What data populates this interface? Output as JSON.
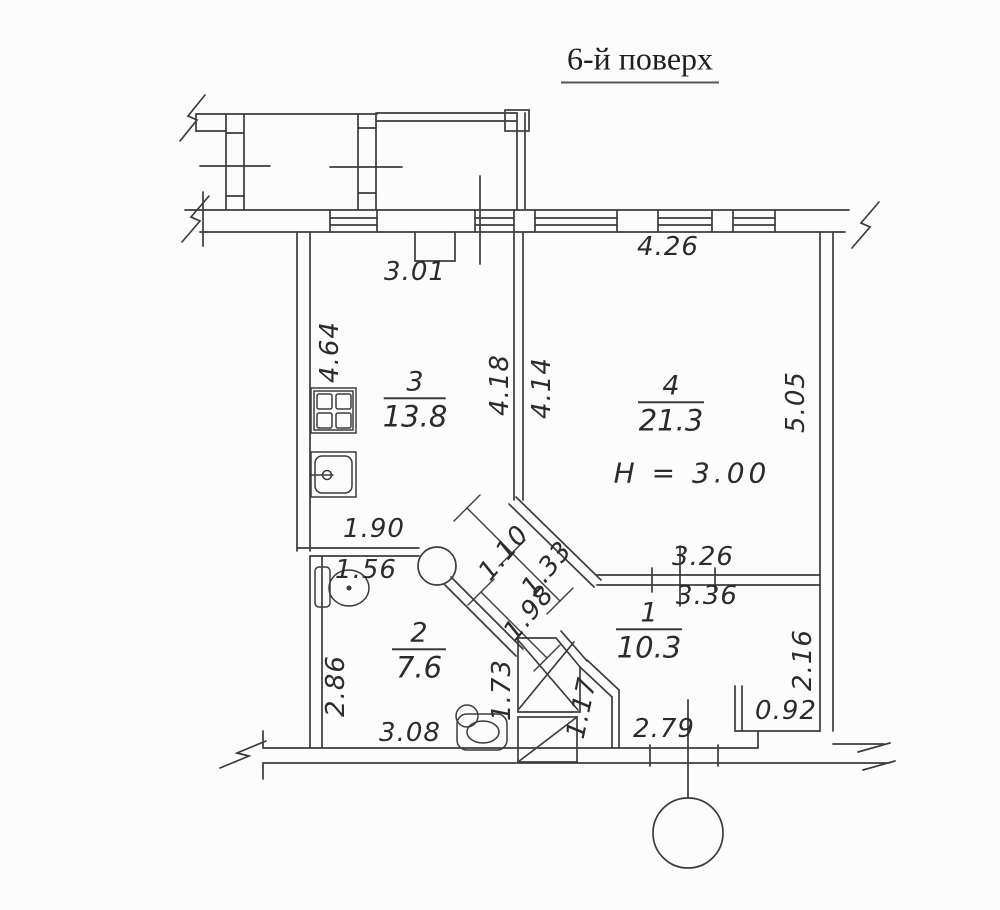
{
  "title": "6-й поверх",
  "rooms": {
    "r1": {
      "number": "1",
      "area": "10.3"
    },
    "r2": {
      "number": "2",
      "area": "7.6"
    },
    "r3": {
      "number": "3",
      "area": "13.8"
    },
    "r4": {
      "number": "4",
      "area": "21.3",
      "height_note": "H = 3.00"
    }
  },
  "dimensions": {
    "balcony_door_width": "3.01",
    "room4_top_width": "4.26",
    "room3_left_height": "4.64",
    "room3_right_height": "4.18",
    "room4_left_height": "4.14",
    "room4_right_height": "5.05",
    "bath_top_width": "1.90",
    "bath_inner_width": "1.56",
    "hall_width_a": "1.10",
    "hall_width_b": "1.33",
    "hall_length": "1.98",
    "room1_top_width_a": "3.26",
    "room1_top_width_b": "3.36",
    "room1_right_height": "2.16",
    "room2_left_height": "2.86",
    "shaft_height": "1.73",
    "hall_bottom_height": "1.17",
    "room2_bottom_width": "3.08",
    "room1_bottom_width": "2.79",
    "niche_width": "0.92"
  }
}
